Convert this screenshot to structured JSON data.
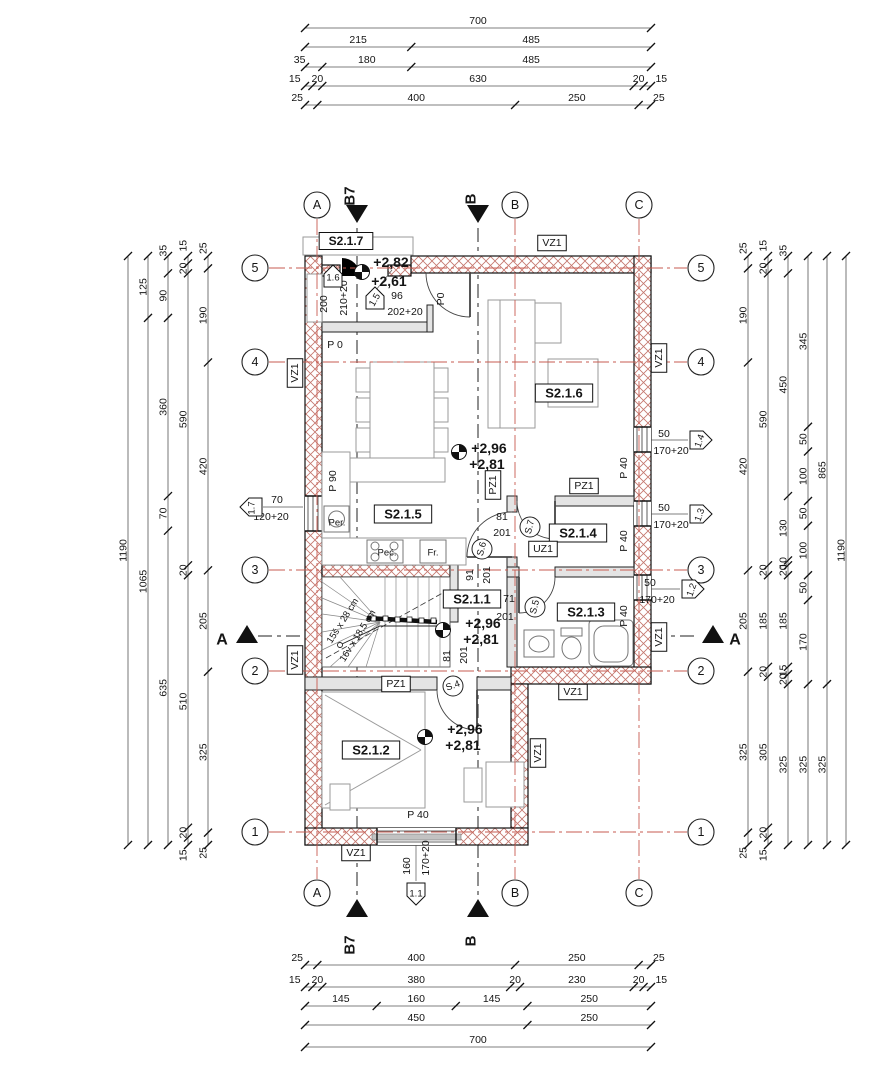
{
  "drawing": {
    "type_note": "architectural floor plan, level S2.1",
    "accent_red": "#c75b50",
    "hatch_color": "#c4766d"
  },
  "dim_chains": [
    {
      "dir": "h",
      "pos": 28,
      "from": 305,
      "to": 651,
      "segs": [
        "700"
      ]
    },
    {
      "dir": "h",
      "pos": 47,
      "from": 305,
      "to": 651,
      "segs": [
        "215",
        "485"
      ]
    },
    {
      "dir": "h",
      "pos": 67,
      "from": 305,
      "to": 651,
      "segs": [
        "35",
        "180",
        "485"
      ]
    },
    {
      "dir": "h",
      "pos": 86,
      "from": 305,
      "to": 651,
      "segs": [
        "15",
        "20",
        "630",
        "20",
        "15"
      ]
    },
    {
      "dir": "h",
      "pos": 105,
      "from": 305,
      "to": 651,
      "segs": [
        "25",
        "400",
        "250",
        "25"
      ]
    },
    {
      "dir": "h",
      "pos": 965,
      "from": 305,
      "to": 651,
      "segs": [
        "25",
        "400",
        "250",
        "25"
      ]
    },
    {
      "dir": "h",
      "pos": 987,
      "from": 305,
      "to": 651,
      "segs": [
        "15",
        "20",
        "380",
        "20",
        "230",
        "20",
        "15"
      ]
    },
    {
      "dir": "h",
      "pos": 1006,
      "from": 305,
      "to": 651,
      "segs": [
        "145",
        "160",
        "145",
        "250"
      ]
    },
    {
      "dir": "h",
      "pos": 1025,
      "from": 305,
      "to": 651,
      "segs": [
        "450",
        "250"
      ]
    },
    {
      "dir": "h",
      "pos": 1047,
      "from": 305,
      "to": 651,
      "segs": [
        "700"
      ]
    },
    {
      "dir": "v",
      "pos": 128,
      "from": 256,
      "to": 845,
      "segs": [
        "1190"
      ]
    },
    {
      "dir": "v",
      "pos": 148,
      "from": 256,
      "to": 845,
      "segs": [
        "125",
        "1065"
      ]
    },
    {
      "dir": "v",
      "pos": 168,
      "from": 256,
      "to": 845,
      "segs": [
        "35",
        "90",
        "360",
        "70",
        "635"
      ]
    },
    {
      "dir": "v",
      "pos": 188,
      "from": 256,
      "to": 845,
      "segs": [
        "15",
        "20",
        "590",
        "20",
        "510",
        "20",
        "15"
      ]
    },
    {
      "dir": "v",
      "pos": 208,
      "from": 256,
      "to": 845,
      "segs": [
        "25",
        "190",
        "420",
        "205",
        "325",
        "25"
      ]
    },
    {
      "dir": "v",
      "pos": 748,
      "from": 256,
      "to": 845,
      "segs": [
        "25",
        "190",
        "420",
        "205",
        "325",
        "25"
      ]
    },
    {
      "dir": "v",
      "pos": 768,
      "from": 256,
      "to": 845,
      "segs": [
        "15",
        "20",
        "590",
        "20",
        "185",
        "20",
        "305",
        "20",
        "15"
      ]
    },
    {
      "dir": "v",
      "pos": 788,
      "from": 256,
      "to": 845,
      "segs": [
        "35",
        "450",
        "130",
        "10",
        "20",
        "185",
        "15",
        "20",
        "325"
      ]
    },
    {
      "dir": "v",
      "pos": 808,
      "from": 256,
      "to": 845,
      "segs": [
        "345",
        "50",
        "100",
        "50",
        "100",
        "50",
        "170",
        "325"
      ]
    },
    {
      "dir": "v",
      "pos": 827,
      "from": 256,
      "to": 845,
      "segs": [
        "865",
        "325"
      ]
    },
    {
      "dir": "v",
      "pos": 846,
      "from": 256,
      "to": 845,
      "segs": [
        "1190"
      ]
    }
  ],
  "grid_bubbles": [
    {
      "t": "A",
      "x": 317,
      "y": 205
    },
    {
      "t": "B",
      "x": 515,
      "y": 205
    },
    {
      "t": "C",
      "x": 639,
      "y": 205
    },
    {
      "t": "A",
      "x": 317,
      "y": 893
    },
    {
      "t": "B",
      "x": 515,
      "y": 893
    },
    {
      "t": "C",
      "x": 639,
      "y": 893
    },
    {
      "t": "5",
      "x": 255,
      "y": 268
    },
    {
      "t": "4",
      "x": 255,
      "y": 362
    },
    {
      "t": "3",
      "x": 255,
      "y": 570
    },
    {
      "t": "2",
      "x": 255,
      "y": 671
    },
    {
      "t": "1",
      "x": 255,
      "y": 832
    },
    {
      "t": "5",
      "x": 701,
      "y": 268
    },
    {
      "t": "4",
      "x": 701,
      "y": 362
    },
    {
      "t": "3",
      "x": 701,
      "y": 570
    },
    {
      "t": "2",
      "x": 701,
      "y": 671
    },
    {
      "t": "1",
      "x": 701,
      "y": 832
    }
  ],
  "labels": [
    {
      "t": "S2.1.7",
      "x": 346,
      "y": 241,
      "s": 12,
      "b": 1,
      "box": 1,
      "n": "room-label-s2-1-7"
    },
    {
      "t": "VZ1",
      "x": 552,
      "y": 243,
      "s": 10.5,
      "box": 1,
      "n": "wall-tag-vz1"
    },
    {
      "t": "+2,82",
      "x": 391,
      "y": 262,
      "s": 14,
      "b": 1,
      "n": "level-value"
    },
    {
      "t": "+2,61",
      "x": 389,
      "y": 281,
      "s": 14,
      "b": 1,
      "n": "level-value"
    },
    {
      "t": "96",
      "x": 397,
      "y": 296,
      "s": 10.5,
      "n": "door-width"
    },
    {
      "t": "202+20",
      "x": 405,
      "y": 312,
      "s": 10.5,
      "n": "door-height"
    },
    {
      "t": "210+20",
      "x": 344,
      "y": 298,
      "s": 10.5,
      "r": -90,
      "n": "opening-dim"
    },
    {
      "t": "200",
      "x": 324,
      "y": 304,
      "s": 10.5,
      "r": -90,
      "n": "opening-dim"
    },
    {
      "t": "P0",
      "x": 441,
      "y": 299,
      "s": 10.5,
      "r": -90,
      "n": "parapet-tag"
    },
    {
      "t": "P 0",
      "x": 335,
      "y": 345,
      "s": 10.5,
      "n": "parapet-tag"
    },
    {
      "t": "VZ1",
      "x": 295,
      "y": 373,
      "s": 10.5,
      "box": 1,
      "r": -90,
      "n": "wall-tag-vz1"
    },
    {
      "t": "S2.1.6",
      "x": 564,
      "y": 393,
      "s": 13,
      "b": 1,
      "box": 1,
      "n": "room-label-s2-1-6"
    },
    {
      "t": "+2,96",
      "x": 489,
      "y": 448,
      "s": 14,
      "b": 1,
      "n": "level-value"
    },
    {
      "t": "+2,81",
      "x": 487,
      "y": 464,
      "s": 14,
      "b": 1,
      "n": "level-value"
    },
    {
      "t": "P 90",
      "x": 333,
      "y": 481,
      "s": 10.5,
      "r": -90,
      "n": "parapet-tag"
    },
    {
      "t": "PZ1",
      "x": 493,
      "y": 485,
      "s": 10.5,
      "box": 1,
      "r": -90,
      "n": "wall-tag-pz1"
    },
    {
      "t": "PZ1",
      "x": 584,
      "y": 486,
      "s": 10.5,
      "box": 1,
      "n": "wall-tag-pz1"
    },
    {
      "t": "S2.1.5",
      "x": 403,
      "y": 514,
      "s": 13,
      "b": 1,
      "box": 1,
      "n": "room-label-s2-1-5"
    },
    {
      "t": "70",
      "x": 277,
      "y": 500,
      "s": 10.5,
      "n": "window-dim"
    },
    {
      "t": "120+20",
      "x": 271,
      "y": 517,
      "s": 10.5,
      "n": "window-dim"
    },
    {
      "t": "50",
      "x": 664,
      "y": 434,
      "s": 10.5,
      "n": "window-dim"
    },
    {
      "t": "170+20",
      "x": 671,
      "y": 451,
      "s": 10.5,
      "n": "window-dim"
    },
    {
      "t": "50",
      "x": 664,
      "y": 508,
      "s": 10.5,
      "n": "window-dim"
    },
    {
      "t": "170+20",
      "x": 671,
      "y": 525,
      "s": 10.5,
      "n": "window-dim"
    },
    {
      "t": "50",
      "x": 650,
      "y": 583,
      "s": 10.5,
      "n": "window-dim"
    },
    {
      "t": "170+20",
      "x": 657,
      "y": 600,
      "s": 10.5,
      "n": "window-dim"
    },
    {
      "t": "P 40",
      "x": 624,
      "y": 468,
      "s": 10.5,
      "r": -90,
      "n": "parapet-tag"
    },
    {
      "t": "P 40",
      "x": 624,
      "y": 541,
      "s": 10.5,
      "r": -90,
      "n": "parapet-tag"
    },
    {
      "t": "P 40",
      "x": 624,
      "y": 616,
      "s": 10.5,
      "r": -90,
      "n": "parapet-tag"
    },
    {
      "t": "S2.1.4",
      "x": 578,
      "y": 533,
      "s": 13,
      "b": 1,
      "box": 1,
      "n": "room-label-s2-1-4"
    },
    {
      "t": "UZ1",
      "x": 543,
      "y": 549,
      "s": 10.5,
      "box": 1,
      "n": "wall-tag-uz1"
    },
    {
      "t": "81",
      "x": 502,
      "y": 517,
      "s": 10.5,
      "n": "door-width"
    },
    {
      "t": "201",
      "x": 502,
      "y": 533,
      "s": 10.5,
      "n": "door-height"
    },
    {
      "t": "Per.",
      "x": 337,
      "y": 523,
      "s": 9.5,
      "n": "appliance-washer"
    },
    {
      "t": "Peć.",
      "x": 387,
      "y": 553,
      "s": 9.5,
      "n": "appliance-stove"
    },
    {
      "t": "Fr.",
      "x": 433,
      "y": 553,
      "s": 9.5,
      "n": "appliance-fridge"
    },
    {
      "t": "91",
      "x": 470,
      "y": 575,
      "s": 10.5,
      "r": -90,
      "n": "door-width"
    },
    {
      "t": "201",
      "x": 487,
      "y": 575,
      "s": 10.5,
      "r": -90,
      "n": "door-height"
    },
    {
      "t": "S2.1.1",
      "x": 472,
      "y": 599,
      "s": 13,
      "b": 1,
      "box": 1,
      "n": "room-label-s2-1-1"
    },
    {
      "t": "71",
      "x": 509,
      "y": 599,
      "s": 10.5,
      "n": "door-width"
    },
    {
      "t": "201",
      "x": 505,
      "y": 617,
      "s": 10.5,
      "n": "door-height"
    },
    {
      "t": "S2.1.3",
      "x": 586,
      "y": 612,
      "s": 13,
      "b": 1,
      "box": 1,
      "n": "room-label-s2-1-3"
    },
    {
      "t": "+2,96",
      "x": 483,
      "y": 623,
      "s": 14,
      "b": 1,
      "n": "level-value"
    },
    {
      "t": "+2,81",
      "x": 481,
      "y": 639,
      "s": 14,
      "b": 1,
      "n": "level-value"
    },
    {
      "t": "15š x 28 cm",
      "x": 343,
      "y": 621,
      "s": 9.5,
      "r": -58,
      "n": "stair-tread-note"
    },
    {
      "t": "16v x 18,5 cm",
      "x": 358,
      "y": 636,
      "s": 9.5,
      "r": -58,
      "n": "stair-riser-note"
    },
    {
      "t": "81",
      "x": 447,
      "y": 656,
      "s": 10.5,
      "r": -90,
      "n": "door-width"
    },
    {
      "t": "201",
      "x": 464,
      "y": 655,
      "s": 10.5,
      "r": -90,
      "n": "door-height"
    },
    {
      "t": "PZ1",
      "x": 396,
      "y": 684,
      "s": 10.5,
      "box": 1,
      "n": "wall-tag-pz1"
    },
    {
      "t": "VZ1",
      "x": 573,
      "y": 692,
      "s": 10.5,
      "box": 1,
      "n": "wall-tag-vz1"
    },
    {
      "t": "VZ1",
      "x": 659,
      "y": 358,
      "s": 10.5,
      "box": 1,
      "r": -90,
      "n": "wall-tag-vz1"
    },
    {
      "t": "VZ1",
      "x": 659,
      "y": 637,
      "s": 10.5,
      "box": 1,
      "r": -90,
      "n": "wall-tag-vz1"
    },
    {
      "t": "VZ1",
      "x": 295,
      "y": 660,
      "s": 10.5,
      "box": 1,
      "r": -90,
      "n": "wall-tag-vz1"
    },
    {
      "t": "S2.1.2",
      "x": 371,
      "y": 750,
      "s": 13,
      "b": 1,
      "box": 1,
      "n": "room-label-s2-1-2"
    },
    {
      "t": "+2,96",
      "x": 465,
      "y": 729,
      "s": 14,
      "b": 1,
      "n": "level-value"
    },
    {
      "t": "+2,81",
      "x": 463,
      "y": 745,
      "s": 14,
      "b": 1,
      "n": "level-value"
    },
    {
      "t": "VZ1",
      "x": 538,
      "y": 753,
      "s": 10.5,
      "box": 1,
      "r": -90,
      "n": "wall-tag-vz1"
    },
    {
      "t": "P 40",
      "x": 418,
      "y": 815,
      "s": 10.5,
      "n": "parapet-tag"
    },
    {
      "t": "VZ1",
      "x": 356,
      "y": 853,
      "s": 10.5,
      "box": 1,
      "n": "wall-tag-vz1"
    },
    {
      "t": "160",
      "x": 407,
      "y": 866,
      "s": 10.5,
      "r": -90,
      "n": "window-dim"
    },
    {
      "t": "170+20",
      "x": 426,
      "y": 858,
      "s": 10.5,
      "r": -90,
      "n": "window-dim"
    }
  ],
  "pentagon_markers": [
    {
      "t": "1.6",
      "x": 333,
      "y": 277,
      "dir": "up"
    },
    {
      "t": "1.5",
      "x": 375,
      "y": 299,
      "dir": "up",
      "tr": -60
    },
    {
      "t": "1.7",
      "x": 252,
      "y": 507,
      "dir": "left",
      "tr": -90
    },
    {
      "t": "1.4",
      "x": 700,
      "y": 440,
      "dir": "right",
      "tr": -70
    },
    {
      "t": "1.3",
      "x": 700,
      "y": 514,
      "dir": "right",
      "tr": -70
    },
    {
      "t": "1.2",
      "x": 692,
      "y": 589,
      "dir": "right",
      "tr": -70
    },
    {
      "t": "1.1",
      "x": 416,
      "y": 893,
      "dir": "down"
    }
  ],
  "door_circles": [
    {
      "t": "S.7",
      "x": 530,
      "y": 527,
      "r": -75
    },
    {
      "t": "S.6",
      "x": 482,
      "y": 549,
      "r": -75
    },
    {
      "t": "S.5",
      "x": 535,
      "y": 607,
      "r": -75
    },
    {
      "t": "S.4",
      "x": 453,
      "y": 686,
      "r": -20
    }
  ],
  "section_letters": [
    {
      "t": "B7",
      "x": 350,
      "y": 196,
      "s": 15,
      "b": 1,
      "r": -90,
      "n": "section-mark-b7"
    },
    {
      "t": "B",
      "x": 471,
      "y": 199,
      "s": 15,
      "b": 1,
      "r": -90,
      "n": "section-mark-b"
    },
    {
      "t": "A",
      "x": 222,
      "y": 640,
      "s": 16,
      "b": 1,
      "n": "section-mark-a"
    },
    {
      "t": "A",
      "x": 735,
      "y": 640,
      "s": 16,
      "b": 1,
      "n": "section-mark-a"
    },
    {
      "t": "B7",
      "x": 350,
      "y": 945,
      "s": 15,
      "b": 1,
      "r": -90,
      "n": "section-mark-b7"
    },
    {
      "t": "B",
      "x": 471,
      "y": 941,
      "s": 15,
      "b": 1,
      "r": -90,
      "n": "section-mark-b"
    }
  ],
  "section_triangles": [
    {
      "x": 357,
      "y": 214,
      "d": "down"
    },
    {
      "x": 478,
      "y": 214,
      "d": "down"
    },
    {
      "x": 357,
      "y": 908,
      "d": "up"
    },
    {
      "x": 478,
      "y": 908,
      "d": "up"
    },
    {
      "x": 247,
      "y": 634,
      "d": "up"
    },
    {
      "x": 713,
      "y": 634,
      "d": "up"
    }
  ],
  "level_symbols": [
    {
      "x": 362,
      "y": 272
    },
    {
      "x": 459,
      "y": 452
    },
    {
      "x": 443,
      "y": 630
    },
    {
      "x": 425,
      "y": 737
    }
  ]
}
